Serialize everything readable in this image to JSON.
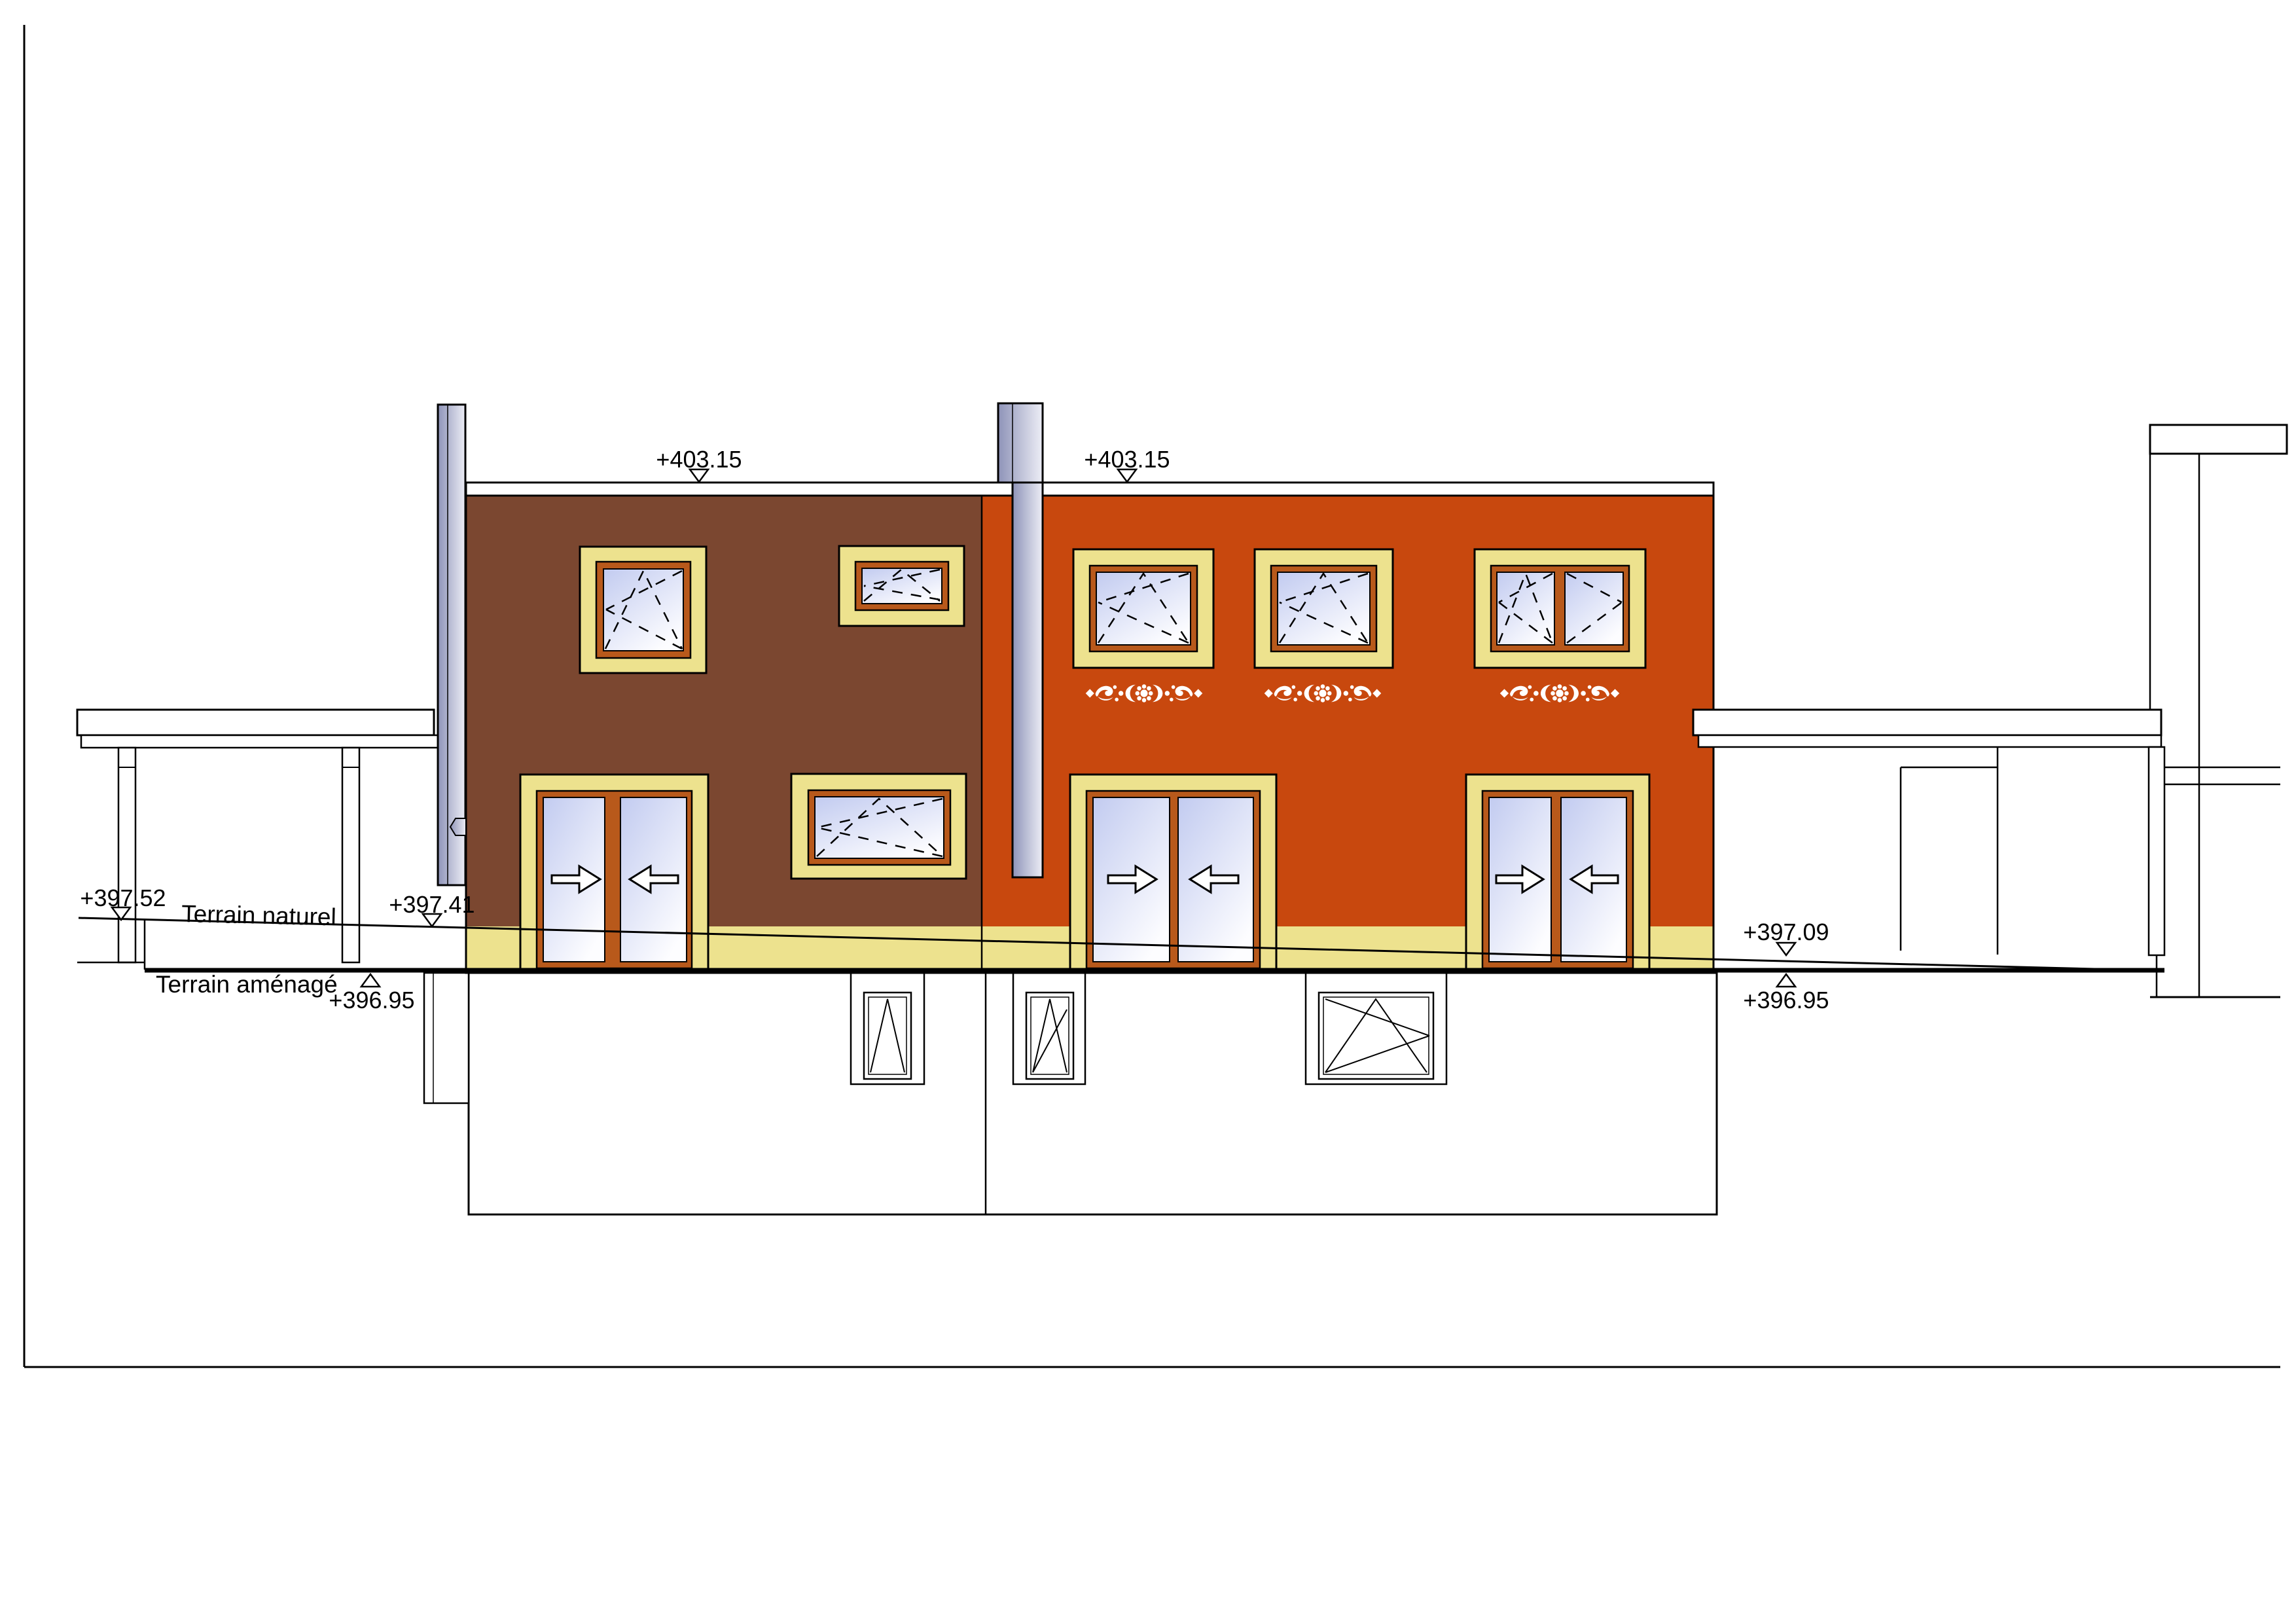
{
  "drawing": {
    "kind": "architectural facade elevation, two attached houses with basement, pergolas and neighbour building",
    "labels": {
      "roof_left": "+403.15",
      "roof_right": "+403.15",
      "terrain_naturel": "Terrain naturel",
      "terrain_amenage": "Terrain aménagé",
      "lvl_left_top": "+397.52",
      "lvl_door_left": "+397.41",
      "lvl_left_bottom": "+396.95",
      "lvl_right_top": "+397.09",
      "lvl_right_bottom": "+396.95"
    },
    "colors": {
      "background": "#ffffff",
      "wall_left": "#7B4730",
      "wall_right": "#C8480E",
      "plinth": "#EDE28E",
      "frame": "#B8591B",
      "glass_dark": "#C2CBF0",
      "glass_light": "#FDFDFF",
      "chimney_dark": "#8E93B8",
      "chimney_light": "#EDEEF6",
      "ornament": "#ffffff",
      "line": "#000000"
    }
  }
}
